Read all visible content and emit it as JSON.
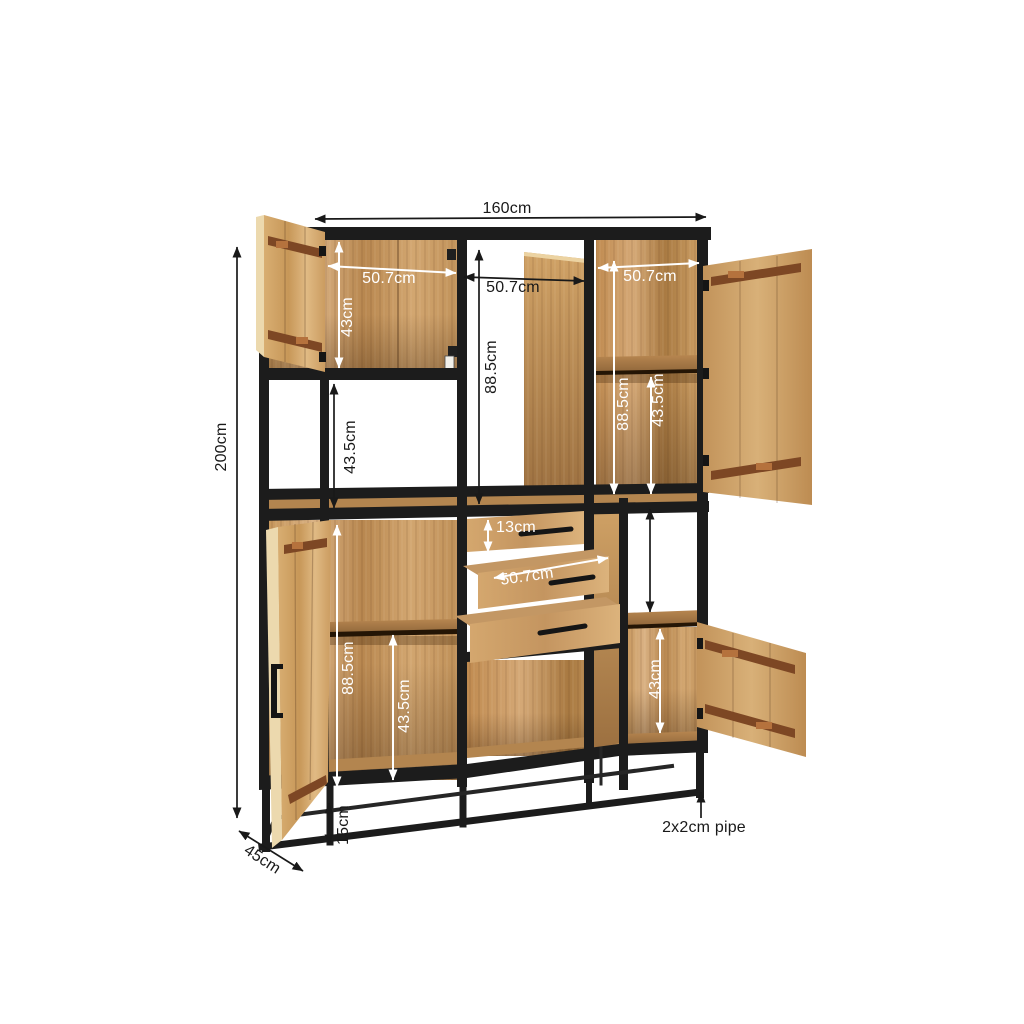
{
  "meta": {
    "title": "Industrial cabinet dimension diagram"
  },
  "dimensions": {
    "overall": {
      "width": "160cm",
      "height": "200cm",
      "depth": "45cm"
    },
    "top_left": {
      "width": "50.7cm",
      "height": "43cm"
    },
    "top_middle": {
      "width": "50.7cm",
      "height": "88.5cm"
    },
    "top_right": {
      "width": "50.7cm",
      "height": "88.5cm",
      "shelf": "43.5cm"
    },
    "middle_left": {
      "height": "43.5cm"
    },
    "drawers": {
      "front_height": "13cm",
      "width": "50.7cm"
    },
    "bottom_left": {
      "height": "88.5cm",
      "shelf": "43.5cm"
    },
    "bottom_right": {
      "height": "43cm"
    },
    "base": {
      "height": "15cm",
      "frame_note": "2x2cm pipe"
    }
  },
  "colors": {
    "frame_black": "#1c1c1c",
    "wood_light": "#d9b183",
    "wood_mid": "#c59559",
    "wood_dark": "#9c7040",
    "strap_brown": "#7d4724",
    "annotation_black": "#191919",
    "annotation_white": "#ffffff",
    "background": "#ffffff"
  }
}
